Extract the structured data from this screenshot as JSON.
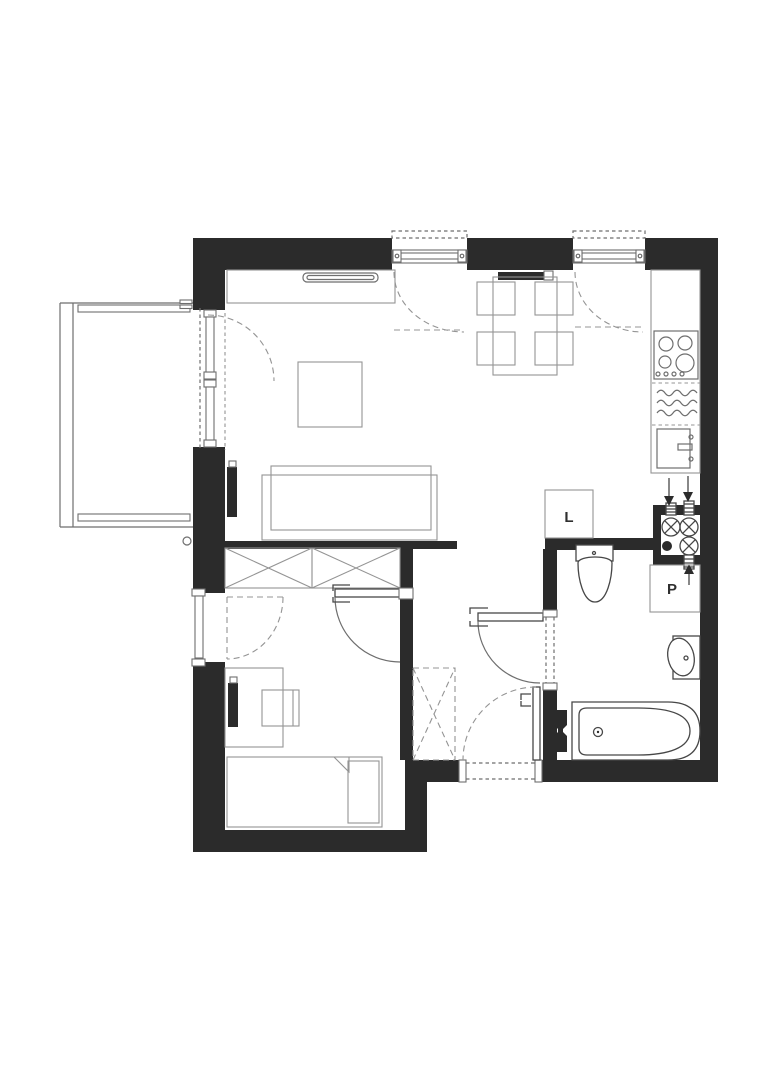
{
  "plan": {
    "type": "apartment-floor-plan",
    "labels": {
      "fridge": "L",
      "washing_machine": "P"
    },
    "colors": {
      "background": "#ffffff",
      "wall": "#2b2b2b",
      "furniture_line": "#949494",
      "mid_line": "#6e6e6e",
      "fixture_line": "#474747",
      "label_text": "#2f2f2f"
    },
    "fixtures": {
      "balcony": [
        "railing",
        "slats",
        "balcony-door-window",
        "drain-pipe"
      ],
      "living_room": [
        "sideboard",
        "tv-bar",
        "coffee-table",
        "sofa",
        "radiator"
      ],
      "dining_area": [
        "dining-table",
        "chair",
        "chair",
        "chair",
        "chair",
        "radiator"
      ],
      "kitchen": [
        "counter",
        "stove-4-burners",
        "dishwasher-waves",
        "sink",
        "fridge-box-L"
      ],
      "hallway": [
        "wardrobe-x",
        "wardrobe-x",
        "optional-wardrobe-dashed",
        "entrance-door"
      ],
      "bedroom": [
        "window",
        "door",
        "desk",
        "chair",
        "radiator",
        "single-bed",
        "pillow"
      ],
      "bathroom": [
        "door",
        "toilet",
        "washbasin",
        "bathtub",
        "towel-radiator",
        "washer-box-P"
      ],
      "installation_shaft": [
        "valve",
        "valve",
        "valve",
        "gas-point",
        "riser-stubs",
        "flow-arrows"
      ]
    }
  }
}
